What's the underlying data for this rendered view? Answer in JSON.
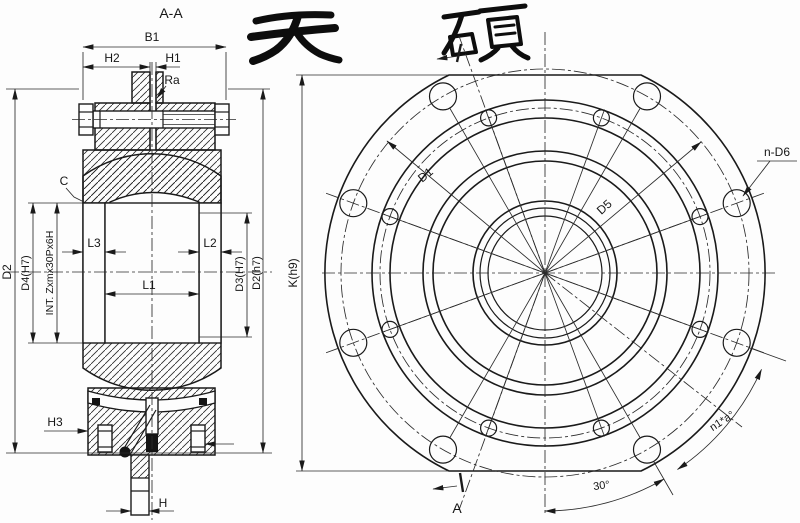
{
  "colors": {
    "ink": "#1a1a1a",
    "background": "#fdfdfd"
  },
  "brand": {
    "name": "天硕",
    "char_left": "天",
    "char_right": "硕"
  },
  "section_view": {
    "title": "A-A",
    "labels": {
      "b1": "B1",
      "h2": "H2",
      "h1": "H1",
      "ra": "Ra",
      "c": "C",
      "d2_outer": "D2",
      "d4_bore": "D4(H7)",
      "int_thread": "INT. Zxmx30Px6H",
      "l3": "L3",
      "l1": "L1",
      "l2": "L2",
      "d3_bore": "D3(H7)",
      "d2_shaft": "D2(h7)",
      "h3": "H3",
      "h": "H"
    }
  },
  "front_view": {
    "labels": {
      "k_dia": "K(h9)",
      "d1": "D1",
      "d5": "D5",
      "n_d6": "n-D6",
      "hole_angle": "n1*a°",
      "angle_30": "30°",
      "section_arrow": "A"
    },
    "hole_counts": {
      "outer_holes": 8,
      "inner_holes": 8
    }
  }
}
